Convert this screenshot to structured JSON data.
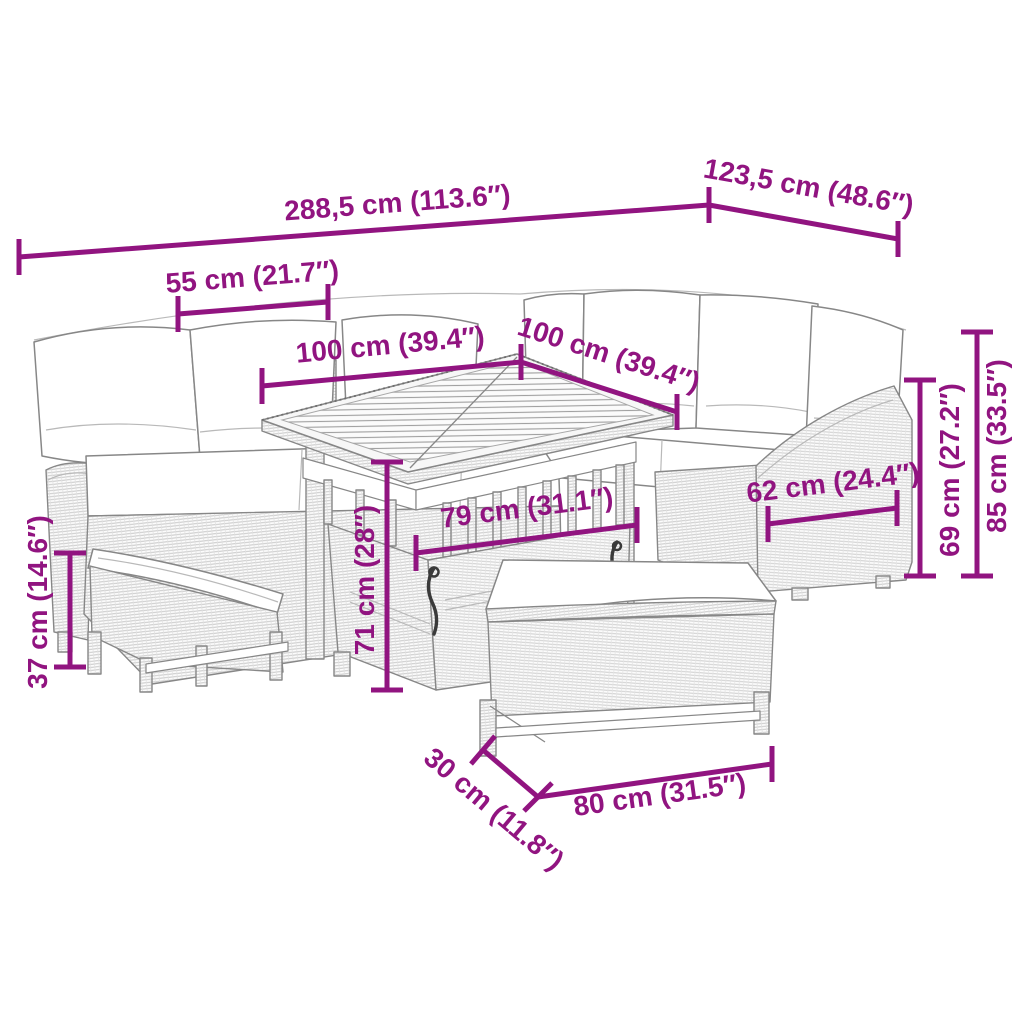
{
  "colors": {
    "dimension": "#911480",
    "outline": "#878787",
    "weave": "#c9c9c9",
    "cushion": "#ffffff",
    "metal": "#3a3a3a",
    "background": "#ffffff"
  },
  "dimensions": {
    "total_width": {
      "label": "288,5 cm (113.6″)"
    },
    "total_depth": {
      "label": "123,5 cm (48.6″)"
    },
    "armrest_width": {
      "label": "55 cm (21.7″)"
    },
    "table_length": {
      "label": "100 cm (39.4″)"
    },
    "table_width": {
      "label": "100 cm (39.4″)"
    },
    "table_inner_width": {
      "label": "79 cm (31.1″)"
    },
    "seat_depth": {
      "label": "62 cm (24.4″)"
    },
    "seat_height": {
      "label": "69 cm (27.2″)"
    },
    "total_height": {
      "label": "85 cm (33.5″)"
    },
    "table_height": {
      "label": "71 cm (28″)"
    },
    "bench_height": {
      "label": "37 cm (14.6″)"
    },
    "bench_depth": {
      "label": "30 cm (11.8″)"
    },
    "bench_length": {
      "label": "80 cm (31.5″)"
    }
  }
}
